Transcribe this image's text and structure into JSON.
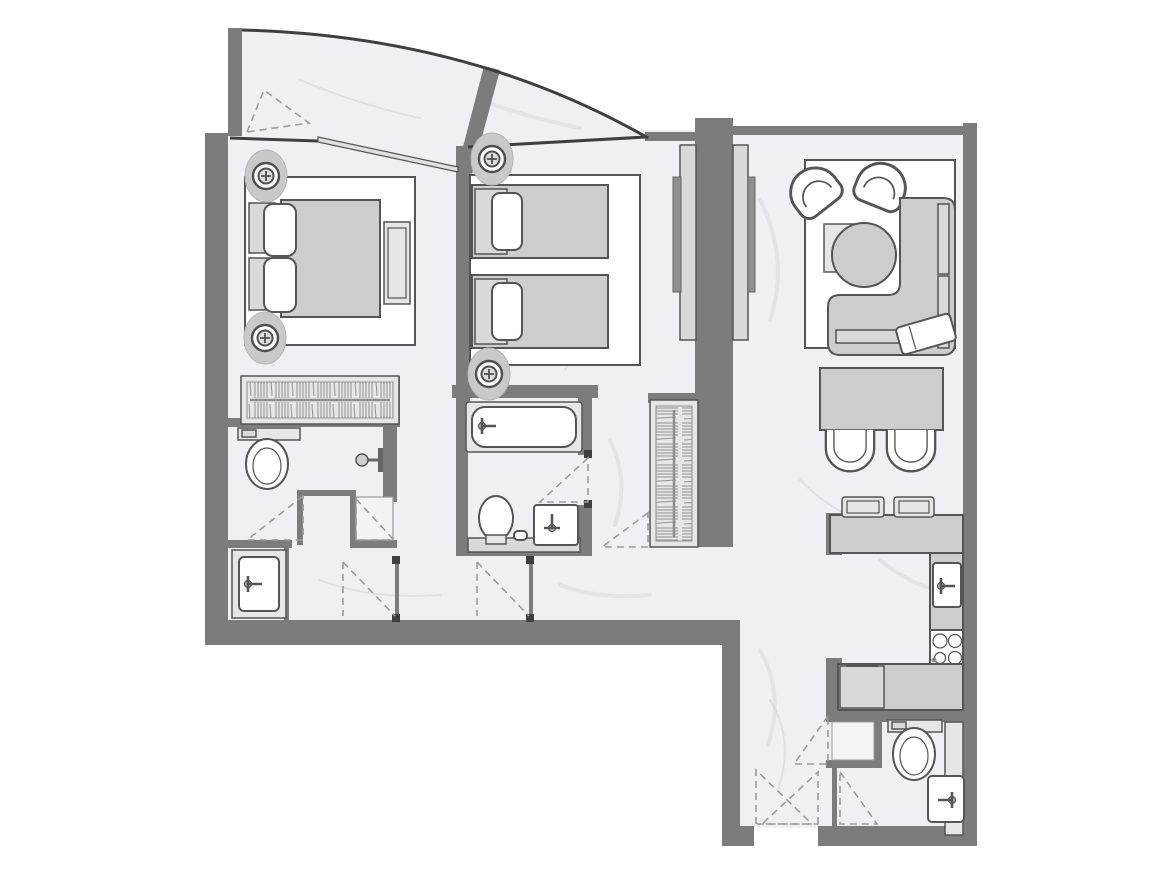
{
  "palette": {
    "wall": "#7c7c7c",
    "wall-dark": "#3f3f3f",
    "outline": "#555555",
    "floor": "#f0f0f2",
    "floor-vein": "#d8d8dd",
    "furniture": "#cdcdcd",
    "furniture-light": "#e6e6e6",
    "furniture-mid": "#d9d9d9",
    "white": "#ffffff",
    "dash": "#9b9b9b",
    "glass": "#e0e0e0"
  },
  "plan": {
    "type": "apartment-floor-plan",
    "style": "grayscale architectural drawing with marble-textured floors, no text labels",
    "rooms": [
      {
        "name": "balcony",
        "features": [
          "curved-glass-front",
          "divider-wall",
          "balcony-door-swing"
        ]
      },
      {
        "name": "master-bedroom",
        "furniture": [
          "double-bed",
          "pillow-2",
          "nightstand-2",
          "foot-bench",
          "wardrobe-hanging-rail",
          "ceiling-downlight-2",
          "sliding-window"
        ]
      },
      {
        "name": "bedroom-2",
        "furniture": [
          "twin-bed-2",
          "pillow-2",
          "headboard-2",
          "tv-media-wall-double-sided",
          "ceiling-downlight-2"
        ]
      },
      {
        "name": "master-bathroom",
        "furniture": [
          "toilet",
          "shower-head",
          "shower-tray",
          "vanity-sink",
          "door-swing-2"
        ]
      },
      {
        "name": "bathroom-2",
        "furniture": [
          "bathtub",
          "toilet",
          "vanity-sink",
          "counter",
          "door-swing"
        ]
      },
      {
        "name": "hallway",
        "furniture": [
          "wardrobe-hanging-rail",
          "door-swing-2",
          "door-post-2"
        ]
      },
      {
        "name": "living-room",
        "furniture": [
          "rug",
          "armchair-2",
          "coffee-table-square",
          "coffee-table-round",
          "corner-sofa",
          "sofa-back-cushions",
          "throw-blanket"
        ]
      },
      {
        "name": "dining-area",
        "furniture": [
          "dining-table",
          "dining-chair-2"
        ]
      },
      {
        "name": "kitchen",
        "furniture": [
          "bar-counter",
          "bar-stool-2",
          "kitchen-sink",
          "cooktop-4-burner",
          "refrigerator",
          "base-counter"
        ]
      },
      {
        "name": "entry-hall",
        "furniture": [
          "entrance-door-swing-2",
          "storage-niche"
        ]
      },
      {
        "name": "powder-room",
        "furniture": [
          "toilet",
          "vanity-sink",
          "vanity-counter",
          "door-swing"
        ]
      }
    ]
  }
}
